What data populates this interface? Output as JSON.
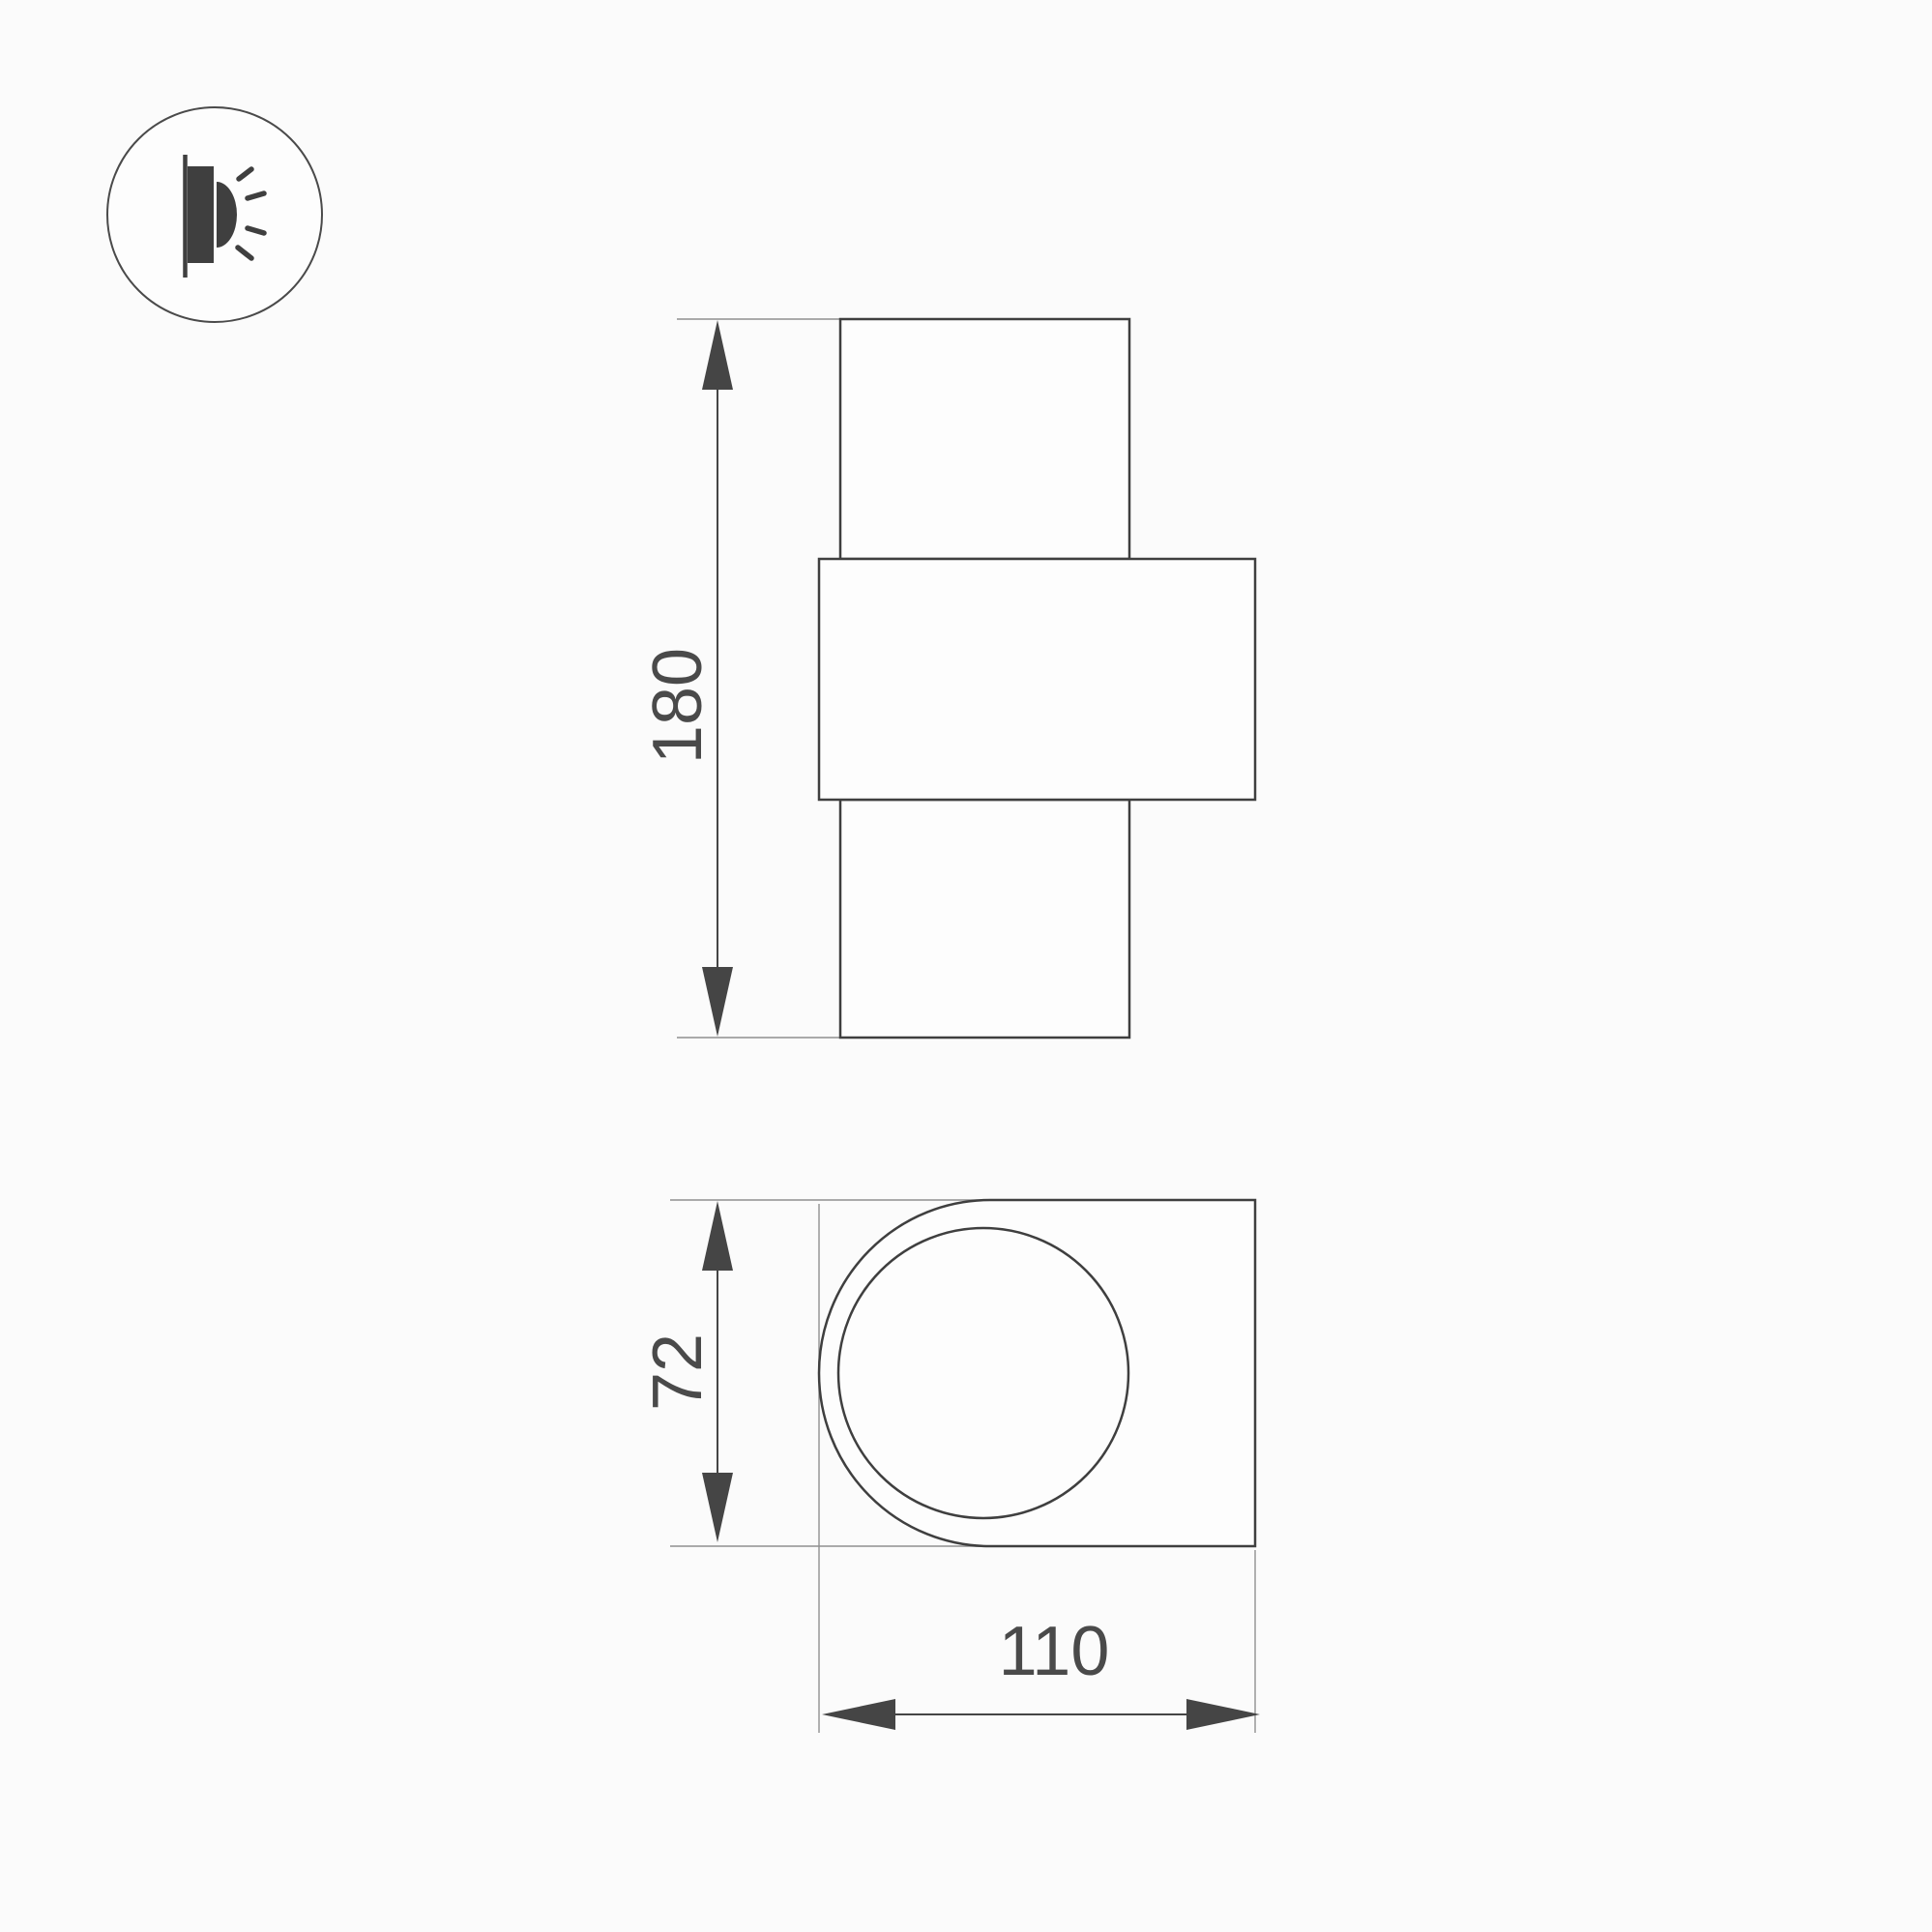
{
  "icon": {
    "name": "wall-lamp-side-icon"
  },
  "views": {
    "front": {
      "height_label": "180"
    },
    "top": {
      "depth_label": "72",
      "width_label": "110"
    }
  },
  "colors": {
    "background": "#fbfbfb",
    "shape_fill": "#fdfdfd",
    "outline": "#3f3f3f",
    "dimension": "#454545",
    "extension": "#909090",
    "text": "#4a4a4a",
    "icon_circle": "#4a4a4a"
  }
}
